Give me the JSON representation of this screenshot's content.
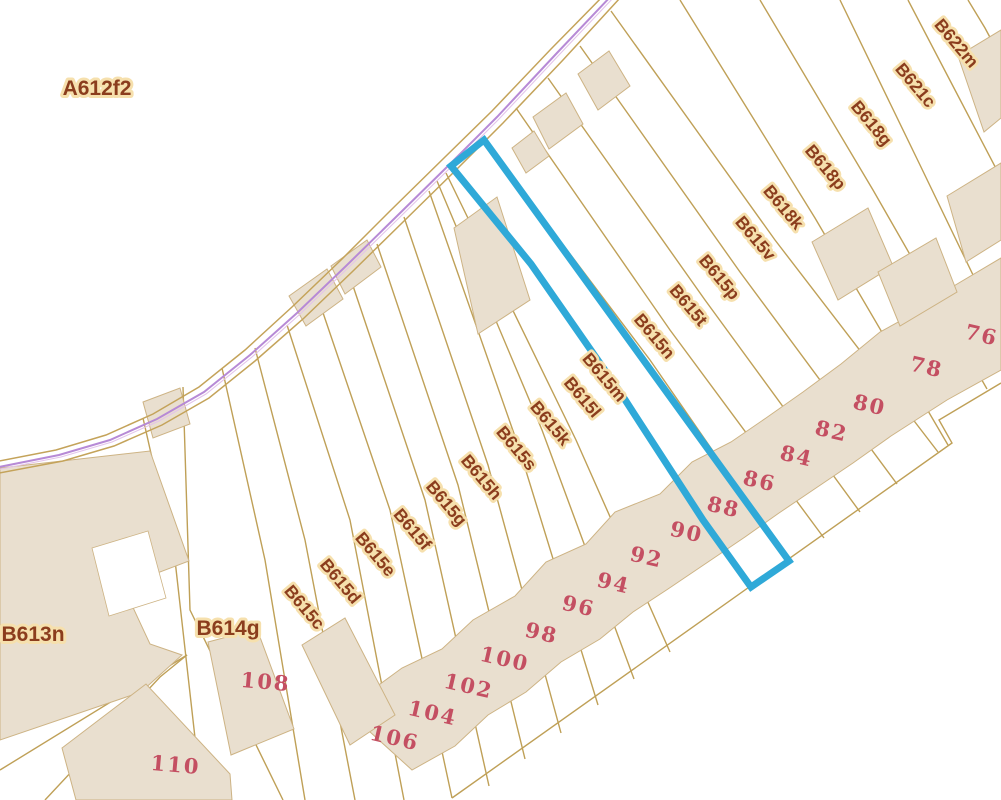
{
  "map": {
    "type": "cadastral-parcel-map",
    "colors": {
      "background": "#ffffff",
      "parcel_line": "#bfa057",
      "building_fill": "#e9dfcf",
      "building_line": "#cdb384",
      "road_edge": "#c4a35a",
      "road_centerline": "#b78ad6",
      "road_centerline_light": "#e3c4ea",
      "selected_parcel": "#2fa9d8",
      "parcel_label_text": "#8b3d1d",
      "parcel_label_halo": "#f6e0ad",
      "house_number_text": "#c44f62"
    },
    "selected_parcel": {
      "highlighted": true,
      "outline_color": "#2fa9d8"
    },
    "labels": {
      "areas": [
        {
          "text": "A612f2",
          "x": 97,
          "y": 95,
          "rotation": 0
        },
        {
          "text": "B613n",
          "x": 33,
          "y": 641,
          "rotation": 0
        },
        {
          "text": "B614g",
          "x": 228,
          "y": 635,
          "rotation": 0
        }
      ],
      "parcels": [
        {
          "text": "B622m",
          "x": 952,
          "y": 47,
          "rotation": 50
        },
        {
          "text": "B621c",
          "x": 911,
          "y": 89,
          "rotation": 50
        },
        {
          "text": "B618g",
          "x": 867,
          "y": 127,
          "rotation": 50
        },
        {
          "text": "B618p",
          "x": 821,
          "y": 171,
          "rotation": 50
        },
        {
          "text": "B618k",
          "x": 779,
          "y": 211,
          "rotation": 50
        },
        {
          "text": "B615v",
          "x": 751,
          "y": 242,
          "rotation": 50
        },
        {
          "text": "B615p",
          "x": 715,
          "y": 281,
          "rotation": 50
        },
        {
          "text": "B615t",
          "x": 684,
          "y": 309,
          "rotation": 50
        },
        {
          "text": "B615n",
          "x": 650,
          "y": 340,
          "rotation": 50
        },
        {
          "text": "B615m",
          "x": 600,
          "y": 381,
          "rotation": 50
        },
        {
          "text": "B615l",
          "x": 578,
          "y": 401,
          "rotation": 50
        },
        {
          "text": "B615k",
          "x": 546,
          "y": 427,
          "rotation": 50
        },
        {
          "text": "B615s",
          "x": 512,
          "y": 452,
          "rotation": 50
        },
        {
          "text": "B615h",
          "x": 477,
          "y": 481,
          "rotation": 50
        },
        {
          "text": "B615g",
          "x": 442,
          "y": 507,
          "rotation": 50
        },
        {
          "text": "B615f",
          "x": 408,
          "y": 533,
          "rotation": 50
        },
        {
          "text": "B615e",
          "x": 371,
          "y": 558,
          "rotation": 50
        },
        {
          "text": "B615d",
          "x": 336,
          "y": 585,
          "rotation": 50
        },
        {
          "text": "B615c",
          "x": 300,
          "y": 611,
          "rotation": 50
        }
      ],
      "house_numbers": [
        {
          "text": "76",
          "x": 980,
          "y": 342,
          "rotation": 13
        },
        {
          "text": "78",
          "x": 925,
          "y": 374,
          "rotation": 13
        },
        {
          "text": "80",
          "x": 868,
          "y": 412,
          "rotation": 13
        },
        {
          "text": "82",
          "x": 830,
          "y": 438,
          "rotation": 13
        },
        {
          "text": "84",
          "x": 795,
          "y": 463,
          "rotation": 13
        },
        {
          "text": "86",
          "x": 758,
          "y": 488,
          "rotation": 13
        },
        {
          "text": "88",
          "x": 722,
          "y": 514,
          "rotation": 13
        },
        {
          "text": "90",
          "x": 685,
          "y": 539,
          "rotation": 13
        },
        {
          "text": "92",
          "x": 645,
          "y": 564,
          "rotation": 13
        },
        {
          "text": "94",
          "x": 612,
          "y": 590,
          "rotation": 13
        },
        {
          "text": "96",
          "x": 577,
          "y": 613,
          "rotation": 13
        },
        {
          "text": "98",
          "x": 540,
          "y": 640,
          "rotation": 13
        },
        {
          "text": "100",
          "x": 503,
          "y": 666,
          "rotation": 13
        },
        {
          "text": "102",
          "x": 467,
          "y": 693,
          "rotation": 13
        },
        {
          "text": "104",
          "x": 431,
          "y": 720,
          "rotation": 13
        },
        {
          "text": "106",
          "x": 393,
          "y": 745,
          "rotation": 13
        },
        {
          "text": "108",
          "x": 265,
          "y": 689,
          "rotation": 5
        },
        {
          "text": "110",
          "x": 175,
          "y": 772,
          "rotation": 5
        }
      ]
    }
  }
}
